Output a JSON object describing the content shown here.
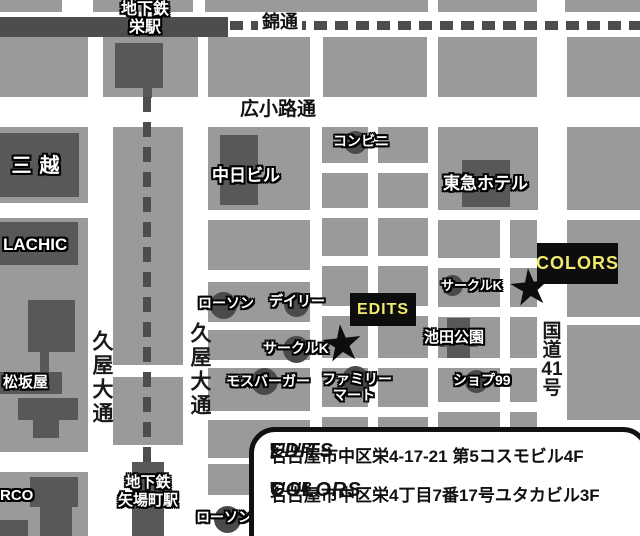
{
  "map": {
    "stations": {
      "sakae_line1": "地下鉄",
      "sakae_line2": "栄駅",
      "yabacho_line1": "地下鉄",
      "yabacho_line2": "矢場町駅"
    },
    "roads": {
      "nishiki": "錦通",
      "hirokoji": "広小路通",
      "hisaya_west": "久屋大通",
      "hisaya_east": "久屋大通",
      "route41": [
        "国",
        "道",
        "41",
        "号"
      ]
    },
    "landmarks": {
      "mitsukoshi": "三越",
      "lachic": "LACHIC",
      "matsuzakaya": "松坂屋",
      "parco_partial": "RCO",
      "chunichi_building": "中日ビル",
      "tokyu_hotel": "東急ホテル",
      "ikeda_park": "池田公園"
    },
    "stores": {
      "konbini": "コンビニ",
      "lawson_north": "ローソン",
      "daily": "デイリー",
      "circle_k_west": "サークルK",
      "circle_k_east": "サークルK",
      "mos_burger": "モスバーガー",
      "family_mart_line1": "ファミリー",
      "family_mart_line2": "マート",
      "shop99": "ショプ99",
      "lawson_south": "ローソン"
    },
    "venues": {
      "edits_label": "EDITS",
      "colors_label": "COLORS"
    },
    "info_box": {
      "bullet": "■",
      "club_prefix": "CLUB",
      "club1_name": "EDITS",
      "club1_address": "名古屋市中区栄4-17-21 第5コスモビル4F",
      "club2_name": "COLORS",
      "club2_address": "名古屋市中区栄4丁目7番17号ユタカビル3F"
    },
    "colors": {
      "block_gray": "#9a9a9a",
      "building_dark": "#585858",
      "rail_dark": "#4d4d4d",
      "accent_yellow": "#f2ea6e",
      "venue_black": "#0d0d0d"
    }
  }
}
